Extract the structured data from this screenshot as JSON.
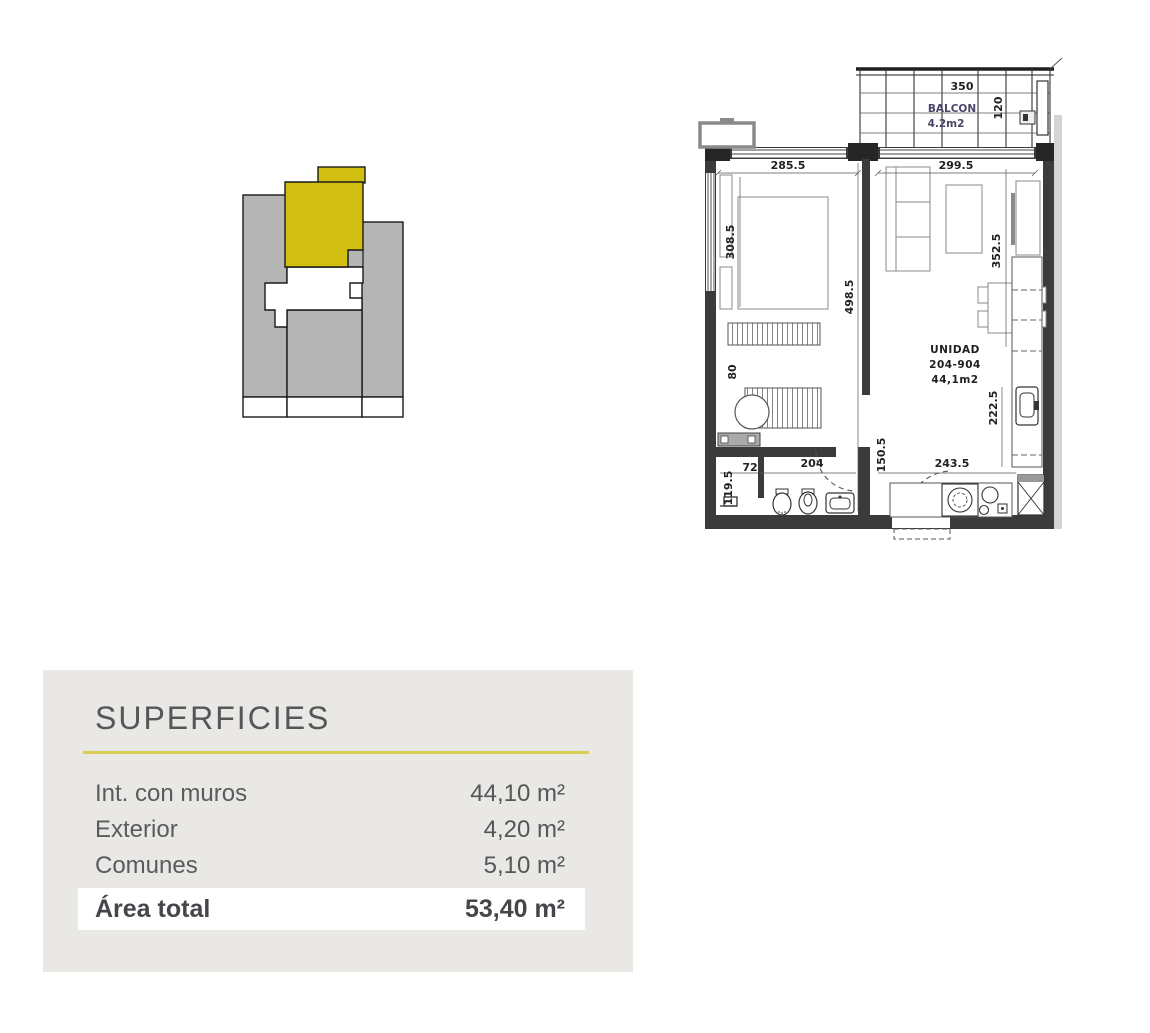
{
  "key_plan": {
    "highlight_color": "#d2be10",
    "building_color": "#b5b5b5"
  },
  "floor_plan": {
    "balcony": {
      "width": "350",
      "label": "BALCON",
      "area": "4.2m2",
      "depth": "120"
    },
    "unit_label": {
      "line1": "UNIDAD",
      "line2": "204-904",
      "line3": "44,1m2"
    },
    "dimensions": {
      "bedroom_width": "285.5",
      "living_width": "299.5",
      "bedroom_depth": "308.5",
      "interior_depth": "498.5",
      "living_depth": "352.5",
      "closet_width": "80",
      "kitchen_depth": "222.5",
      "bath_door": "150.5",
      "shower_depth": "119.5",
      "bath_inner": "72",
      "bath_width": "204",
      "kitchen_width": "243.5"
    }
  },
  "superficies": {
    "title": "SUPERFICIES",
    "rows": [
      {
        "label": "Int. con muros",
        "value": "44,10 m²"
      },
      {
        "label": "Exterior",
        "value": "4,20 m²"
      },
      {
        "label": "Comunes",
        "value": "5,10 m²"
      }
    ],
    "total_label": "Área total",
    "total_value": "53,40 m²"
  }
}
